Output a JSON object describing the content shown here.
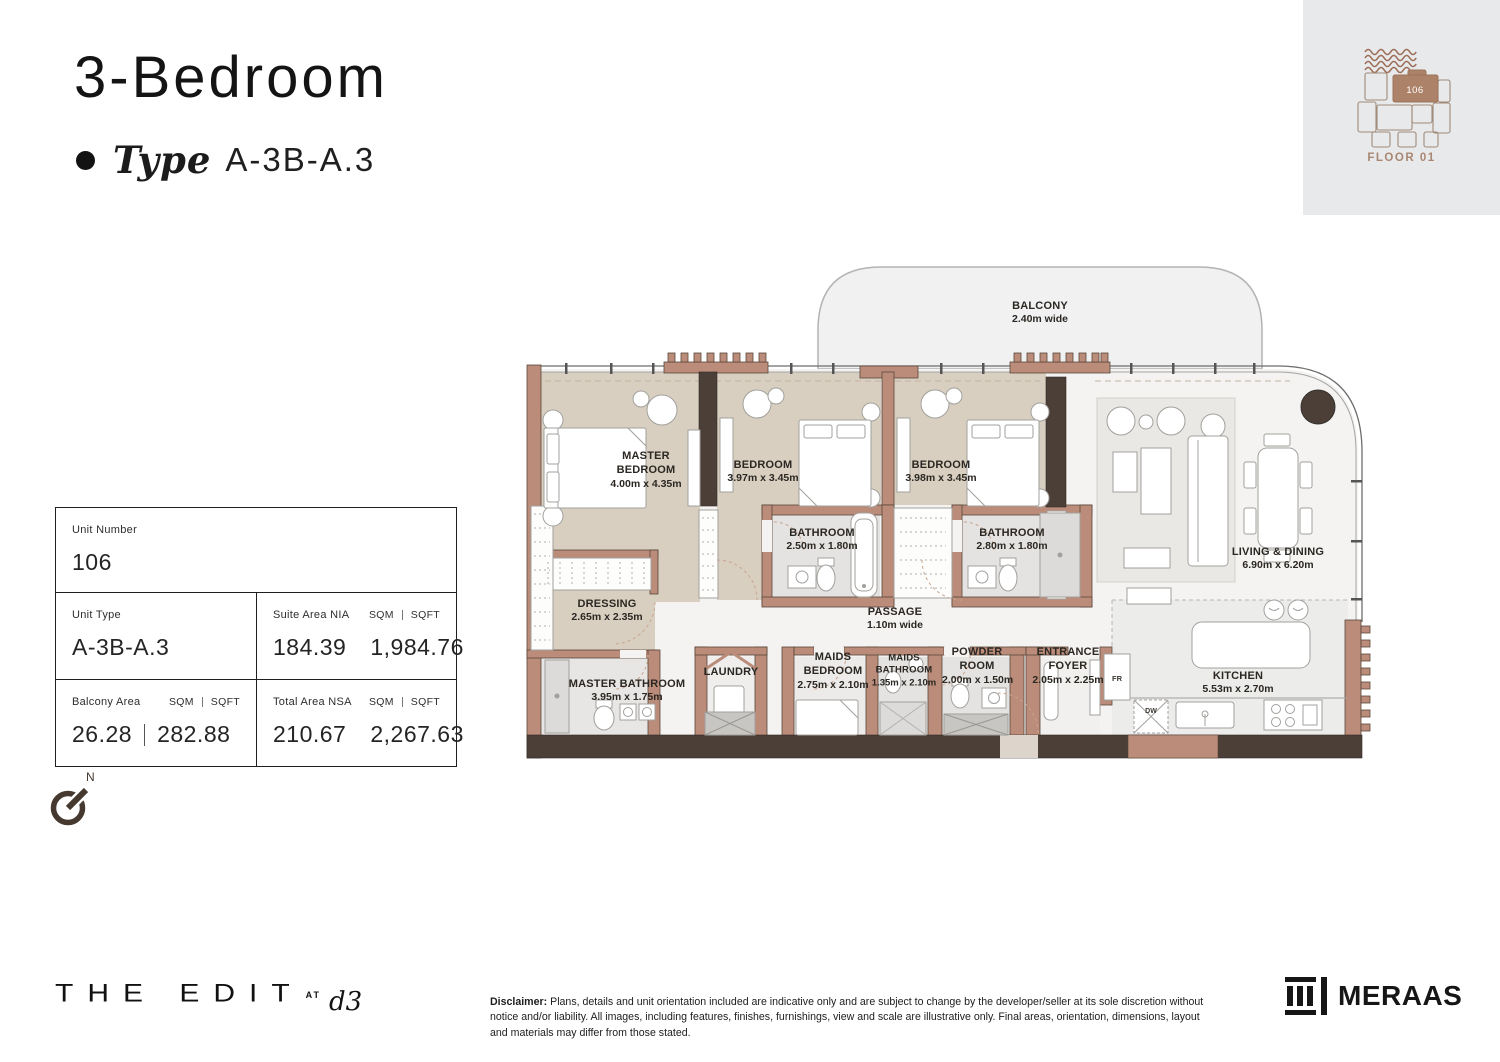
{
  "header": {
    "title": "3-Bedroom",
    "type_label": "Type",
    "type_value": "A-3B-A.3"
  },
  "locator": {
    "unit_number": "106",
    "floor_label": "FLOOR 01"
  },
  "info": {
    "unit_number": {
      "label": "Unit Number",
      "value": "106"
    },
    "unit_type": {
      "label": "Unit Type",
      "value": "A-3B-A.3"
    },
    "units": {
      "sqm": "SQM",
      "sqft": "SQFT"
    },
    "suite_area": {
      "label": "Suite Area NIA",
      "sqm": "184.39",
      "sqft": "1,984.76"
    },
    "balcony_area": {
      "label": "Balcony Area",
      "sqm": "26.28",
      "sqft": "282.88"
    },
    "total_area": {
      "label": "Total Area NSA",
      "sqm": "210.67",
      "sqft": "2,267.63"
    }
  },
  "compass": {
    "north": "N"
  },
  "floorplan": {
    "balcony": {
      "name": "BALCONY",
      "dims": "2.40m wide"
    },
    "master_bedroom": {
      "name": "MASTER BEDROOM",
      "dims": "4.00m x 4.35m"
    },
    "bedroom2": {
      "name": "BEDROOM",
      "dims": "3.97m x 3.45m"
    },
    "bedroom3": {
      "name": "BEDROOM",
      "dims": "3.98m x 3.45m"
    },
    "bathroom2": {
      "name": "BATHROOM",
      "dims": "2.50m x 1.80m"
    },
    "bathroom3": {
      "name": "BATHROOM",
      "dims": "2.80m x 1.80m"
    },
    "dressing": {
      "name": "DRESSING",
      "dims": "2.65m x 2.35m"
    },
    "master_bathroom": {
      "name": "MASTER BATHROOM",
      "dims": "3.95m x 1.75m"
    },
    "laundry": {
      "name": "LAUNDRY",
      "dims": ""
    },
    "passage": {
      "name": "PASSAGE",
      "dims": "1.10m wide"
    },
    "maids_bedroom": {
      "name": "MAIDS BEDROOM",
      "dims": "2.75m x 2.10m"
    },
    "maids_bathroom": {
      "name": "MAIDS BATHROOM",
      "dims": "1.35m x 2.10m"
    },
    "powder_room": {
      "name": "POWDER ROOM",
      "dims": "2.00m x 1.50m"
    },
    "entrance_foyer": {
      "name": "ENTRANCE FOYER",
      "dims": "2.05m x 2.25m"
    },
    "living_dining": {
      "name": "LIVING & DINING",
      "dims": "6.90m x 6.20m"
    },
    "kitchen": {
      "name": "KITCHEN",
      "dims": "5.53m x 2.70m"
    },
    "appliances": {
      "fridge": "FR",
      "dishwasher": "DW"
    }
  },
  "footer": {
    "brand": {
      "name": "THE EDIT",
      "at": "AT",
      "d3": "d3"
    },
    "disclaimer": {
      "prefix": "Disclaimer:",
      "text": "Plans, details and unit orientation included are indicative only and are subject to change by the developer/seller at its sole discretion without notice and/or liability. All images, including features, finishes, furnishings, view and scale are illustrative only. Final areas, orientation, dimensions, layout and materials may differ from those stated."
    },
    "developer": "MERAAS"
  },
  "colors": {
    "accent_brown": "#ac8268",
    "wall_tan": "#bb8c79",
    "wall_dark": "#4c3f37",
    "room_beige": "#d8cfc0",
    "room_gray": "#e4e3e1",
    "locator_bg": "#e8e9eb"
  }
}
